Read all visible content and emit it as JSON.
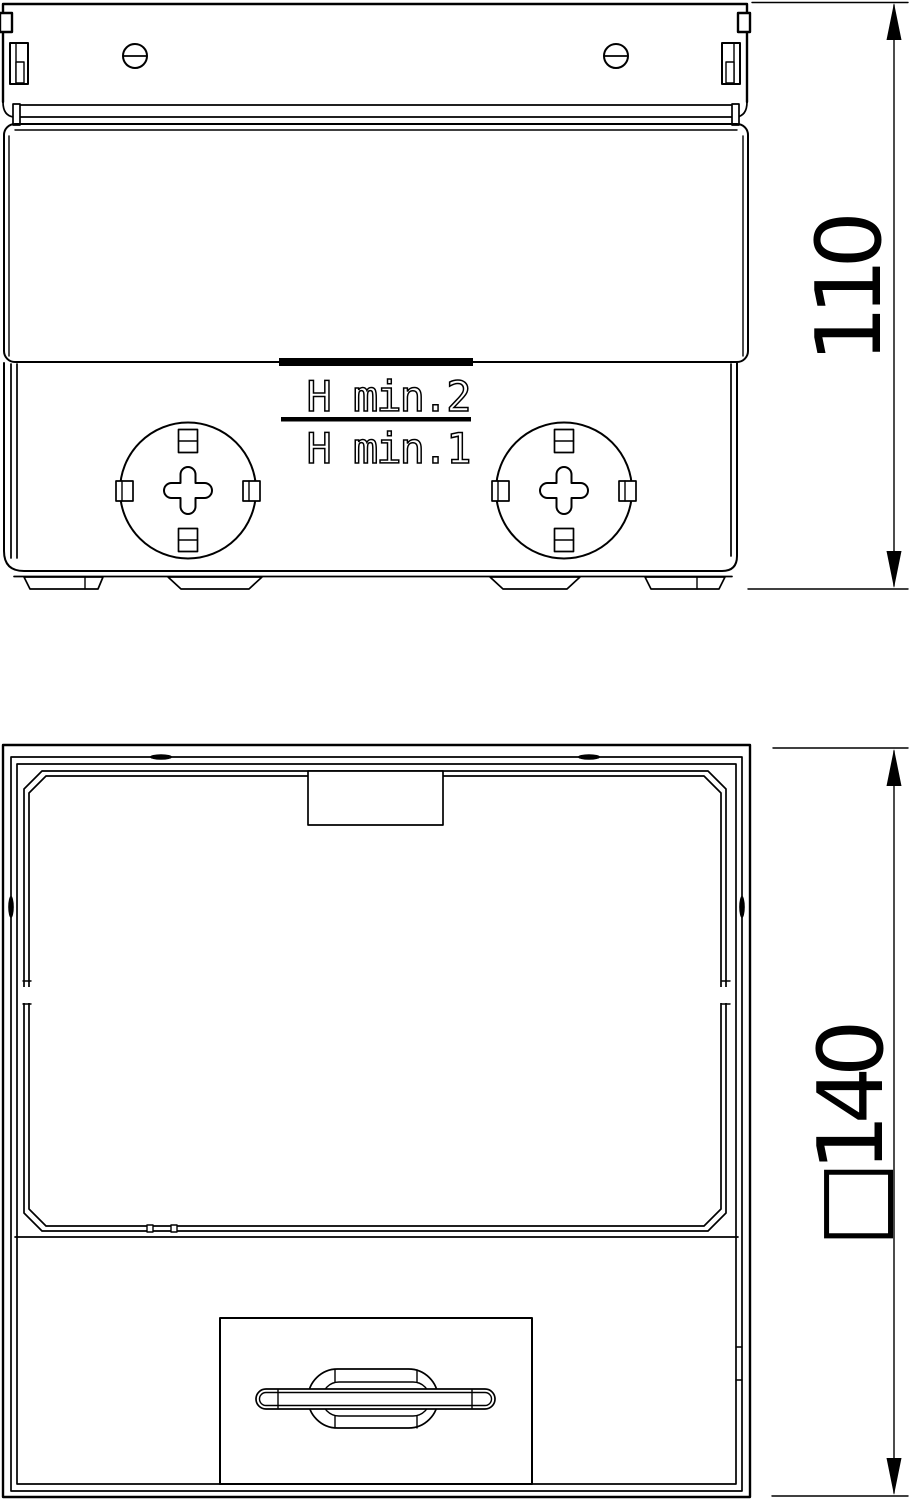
{
  "drawing": {
    "line_color": "#000000",
    "background_color": "#ffffff",
    "side_view": {
      "marking_top": "H min.2",
      "marking_bottom": "H min.1",
      "dimension_height": "110"
    },
    "plan_view": {
      "dimension_width": "□140"
    }
  }
}
